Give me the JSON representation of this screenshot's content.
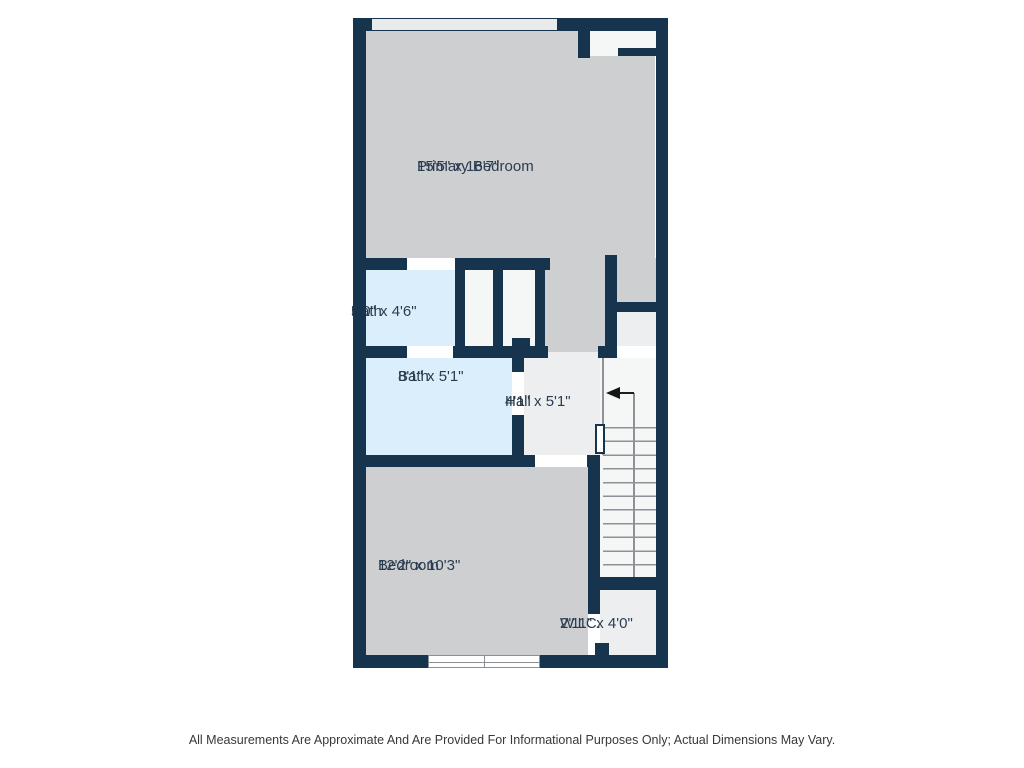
{
  "colors": {
    "wall": "#17344e",
    "floor": "#cdcfd1",
    "floor-light": "#edeeef",
    "floor-white": "#f5f6f6",
    "bath": "#daeffb",
    "label": "#2a3c50",
    "stair-line": "#8d9296",
    "footer": "#383838",
    "bg": "#ffffff"
  },
  "rooms": [
    {
      "name": "Primary Bedroom",
      "dimensions": "15'5\" x 16'7\""
    },
    {
      "name": "Bath",
      "dimensions": "5'0\" x 4'6\""
    },
    {
      "name": "Bath",
      "dimensions": "8'1\" x 5'1\""
    },
    {
      "name": "Hall",
      "dimensions": "4'1\" x 5'1\""
    },
    {
      "name": "Bedroom",
      "dimensions": "12'2\" x 10'3\""
    },
    {
      "name": "W.I.C.",
      "dimensions": "2'11\" x 4'0\""
    }
  ],
  "stairs": {
    "arrow_direction": "left"
  },
  "footer": {
    "disclaimer": "All Measurements Are Approximate And Are Provided For Informational Purposes Only; Actual Dimensions May Vary."
  }
}
